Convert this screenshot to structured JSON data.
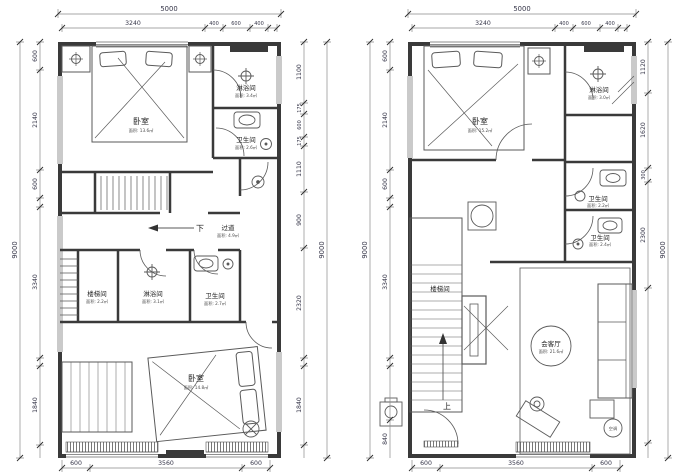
{
  "colors": {
    "wall": "#3a3a3a",
    "line": "#5a5a5a",
    "dim_line": "#8a8a8a",
    "dim_text": "#37374a",
    "room_text": "#1f1f1f"
  },
  "shared": {
    "top_total": "5000",
    "top_segments": [
      "3240",
      "400",
      "600",
      "400"
    ],
    "side_total": "9000",
    "bottom_segments": [
      "600",
      "3560",
      "600"
    ],
    "bottom_total": "5000"
  },
  "plan1": {
    "left_chain": [
      "600",
      "2140",
      "600",
      "3340",
      "1840"
    ],
    "right_chain": [
      "1100",
      "175",
      "600",
      "175",
      "1110",
      "900",
      "2320",
      "1840"
    ],
    "down_label": "下",
    "rooms": {
      "bedroom_top": {
        "name": "卧室",
        "area": "面积: 13.6㎡"
      },
      "shower_top": {
        "name": "淋浴间",
        "area": "面积: 3.4㎡"
      },
      "bath_top": {
        "name": "卫生间",
        "area": "面积: 2.6㎡"
      },
      "corridor": {
        "name": "过道",
        "area": "面积: 4.9㎡"
      },
      "stairwell": {
        "name": "楼梯间",
        "area": "面积: 2.2㎡"
      },
      "shower_mid": {
        "name": "淋浴间",
        "area": "面积: 3.1㎡"
      },
      "bath_mid": {
        "name": "卫生间",
        "area": "面积: 2.7㎡"
      },
      "bedroom_bottom": {
        "name": "卧室",
        "area": "面积: 14.8㎡"
      }
    }
  },
  "plan2": {
    "left_chain": [
      "600",
      "2140",
      "600",
      "3340",
      "840"
    ],
    "right_chain": [
      "1120",
      "1620",
      "300",
      "2300"
    ],
    "up_label": "上",
    "ac_label": "空调",
    "rooms": {
      "bedroom": {
        "name": "卧室",
        "area": "面积: 15.2㎡"
      },
      "shower": {
        "name": "淋浴间",
        "area": "面积: 3.0㎡"
      },
      "bath_upper": {
        "name": "卫生间",
        "area": "面积: 2.2㎡"
      },
      "bath_lower": {
        "name": "卫生间",
        "area": "面积: 2.4㎡"
      },
      "stairwell": {
        "name": "楼梯间"
      },
      "living": {
        "name": "会客厅",
        "area": "面积: 21.6㎡"
      }
    }
  }
}
